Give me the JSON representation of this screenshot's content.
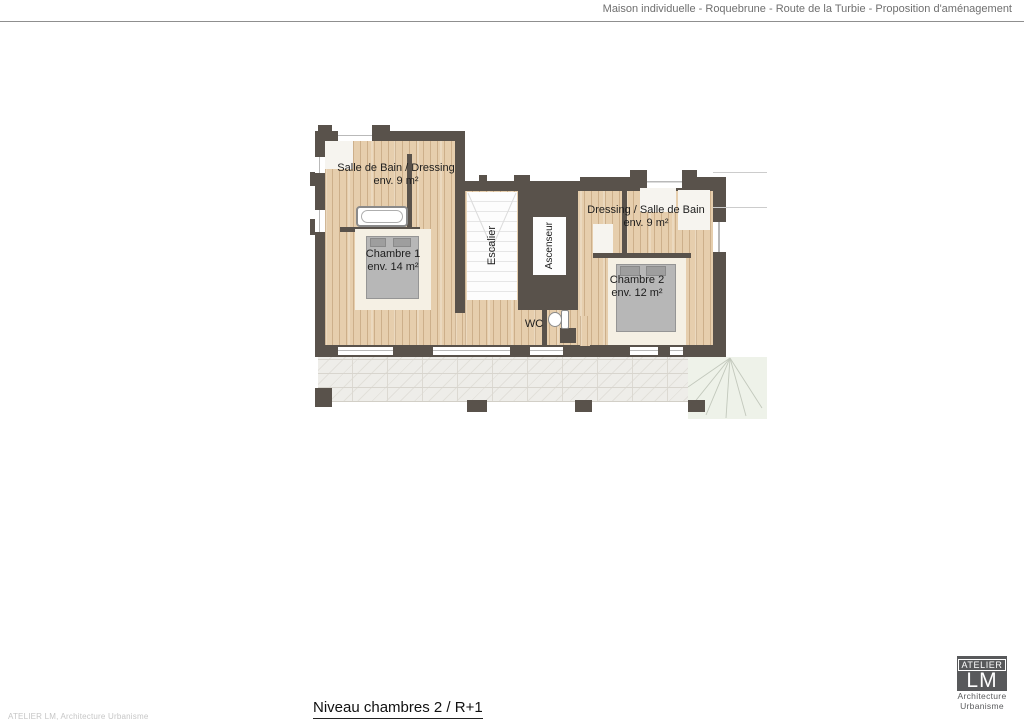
{
  "header": {
    "title": "Maison individuelle - Roquebrune - Route de la Turbie - Proposition d'aménagement"
  },
  "plan": {
    "rooms": {
      "bath1": {
        "name": "Salle de Bain / Dressing",
        "area": "env. 9 m²"
      },
      "bedroom1": {
        "name": "Chambre 1",
        "area": "env. 14 m²"
      },
      "stairs": {
        "name": "Escalier"
      },
      "elevator": {
        "name": "Ascenseur"
      },
      "bath2": {
        "name": "Dressing / Salle de Bain",
        "area": "env. 9 m²"
      },
      "bedroom2": {
        "name": "Chambre 2",
        "area": "env. 12 m²"
      },
      "wc": {
        "name": "WC"
      }
    },
    "colors": {
      "wall": "#59524b",
      "wood_floor": "#e6cead",
      "stone_terrace": "#eeede9",
      "exterior_stair_area": "#eef2e9"
    }
  },
  "footer": {
    "plan_title": "Niveau chambres 2 / R+1",
    "credit": "ATELIER LM, Architecture Urbanisme"
  },
  "logo": {
    "studio": "ATELIER",
    "initials": "LM",
    "line1": "Architecture",
    "line2": "Urbanisme"
  }
}
